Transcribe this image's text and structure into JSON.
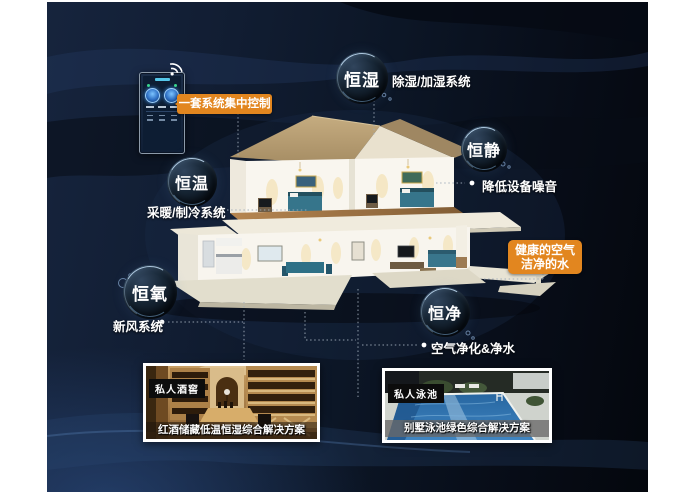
{
  "page": {
    "background": "#0d1828",
    "frame": "#ffffff"
  },
  "control_panel": {
    "label": "一套系统集中控制"
  },
  "bubbles": [
    {
      "label": "恒湿",
      "annotation": "除湿/加湿系统"
    },
    {
      "label": "恒静",
      "annotation": "降低设备噪音"
    },
    {
      "label": "恒温",
      "annotation": "采暖/制冷系统"
    },
    {
      "label": "恒氧",
      "annotation": "新风系统"
    },
    {
      "label": "恒净",
      "annotation": "空气净化&净水"
    }
  ],
  "benefit_box": {
    "line1": "健康的空气",
    "line2": "洁净的水"
  },
  "photos": {
    "wine": {
      "tag": "私人酒窖",
      "caption": "红酒储藏低温恒湿综合解决方案"
    },
    "pool": {
      "tag": "私人泳池",
      "caption": "别墅泳池绿色综合解决方案"
    }
  },
  "colors": {
    "accent_orange": "#e2861f",
    "deep_navy": "#0d1828",
    "connector_grey": "#9fabb9",
    "bubble_rim": "#bcd9ee"
  }
}
